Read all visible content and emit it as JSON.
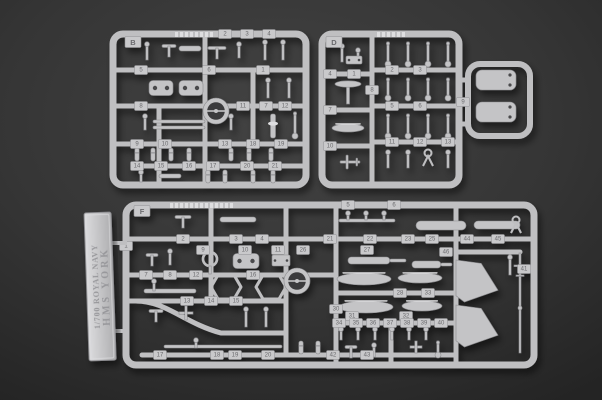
{
  "photo": {
    "type": "product-photo",
    "subject": "injection-molded plastic model kit sprues on dark backdrop",
    "width": 602,
    "height": 400
  },
  "colors": {
    "bg_center": "#434343",
    "bg_mid": "#353535",
    "bg_edge": "#242424",
    "plastic": "#c4c4c6",
    "plastic_light": "#dedee0",
    "plastic_dark": "#8b8b8e",
    "rail": "#bfbfc1",
    "tag_fill": "#c9c9cb",
    "tag_edge": "#8e8e91",
    "tag_text": "#6b6b6e",
    "hole": "#4a4a4c",
    "ring_hole": "#3a3a3c",
    "shell_band": "#a0a0a3",
    "plate_light": "#dcdcde",
    "plate_dark": "#aeaeb0",
    "plate_text": "#96969a",
    "plate_edge": "#8f8f93"
  },
  "nameplate": {
    "line1": "1/700 ROYAL NAVY",
    "line2": "HMS YORK",
    "x": 84,
    "y": 213,
    "w": 27,
    "h": 148,
    "tilt": -2,
    "connectors": [
      [
        109,
        241,
        18,
        4
      ],
      [
        107,
        329,
        20,
        4
      ]
    ]
  },
  "sprues": [
    {
      "id": "sprue-b",
      "label": "B",
      "label_pos": [
        20,
        8
      ],
      "frame": {
        "x": 113,
        "y": 34,
        "w": 193,
        "h": 151,
        "r": 10
      },
      "rails": [
        [
          0,
          36,
          193,
          36
        ],
        [
          0,
          72,
          193,
          72
        ],
        [
          0,
          110,
          193,
          110
        ],
        [
          24,
          132,
          193,
          132
        ],
        [
          92,
          0,
          92,
          151
        ],
        [
          46,
          72,
          46,
          151
        ],
        [
          140,
          36,
          140,
          110
        ]
      ],
      "curves": [],
      "loops": [],
      "tags": [
        [
          "2",
          112,
          0
        ],
        [
          "3",
          134,
          0
        ],
        [
          "4",
          156,
          0
        ],
        [
          "5",
          28,
          36
        ],
        [
          "6",
          96,
          36
        ],
        [
          "1",
          150,
          36
        ],
        [
          "8",
          28,
          72
        ],
        [
          "11",
          130,
          72
        ],
        [
          "7",
          153,
          72
        ],
        [
          "12",
          172,
          72
        ],
        [
          "9",
          24,
          110
        ],
        [
          "10",
          52,
          110
        ],
        [
          "13",
          112,
          110
        ],
        [
          "18",
          140,
          110
        ],
        [
          "19",
          168,
          110
        ],
        [
          "14",
          24,
          132
        ],
        [
          "15",
          48,
          132
        ],
        [
          "16",
          76,
          132
        ],
        [
          "17",
          100,
          132
        ],
        [
          "20",
          134,
          132
        ],
        [
          "21",
          162,
          132
        ]
      ],
      "parts": [
        [
          "ridge",
          62,
          -2,
          36
        ],
        [
          "pinu",
          34,
          8,
          18
        ],
        [
          "tee",
          56,
          12,
          14
        ],
        [
          "barh",
          66,
          12,
          22,
          5
        ],
        [
          "tee",
          104,
          14,
          18
        ],
        [
          "pinu",
          126,
          8,
          16
        ],
        [
          "pinu",
          152,
          6,
          20
        ],
        [
          "pinu",
          170,
          6,
          20
        ],
        [
          "clamp",
          48,
          54,
          24,
          15
        ],
        [
          "clamp",
          78,
          54,
          24,
          15
        ],
        [
          "ringbig",
          103,
          77,
          13
        ],
        [
          "pinu",
          155,
          44,
          20
        ],
        [
          "pinu",
          176,
          44,
          20
        ],
        [
          "colm",
          160,
          80,
          24
        ],
        [
          "pinb",
          182,
          78,
          26
        ],
        [
          "pinu",
          32,
          80,
          16
        ],
        [
          "barh",
          40,
          86,
          52,
          3
        ],
        [
          "barh",
          40,
          92,
          52,
          3
        ],
        [
          "pinu",
          118,
          80,
          16
        ],
        [
          "shell",
          24,
          114
        ],
        [
          "shell",
          40,
          114
        ],
        [
          "shell",
          58,
          114
        ],
        [
          "shell",
          76,
          114
        ],
        [
          "shell",
          118,
          114
        ],
        [
          "shell",
          136,
          114
        ],
        [
          "shell",
          158,
          114
        ],
        [
          "pinu",
          28,
          136,
          12
        ],
        [
          "barh",
          46,
          140,
          22,
          4
        ],
        [
          "shell",
          95,
          136
        ],
        [
          "shell",
          112,
          136
        ],
        [
          "shell",
          140,
          136
        ],
        [
          "shell",
          160,
          136
        ]
      ]
    },
    {
      "id": "sprue-d",
      "label": "D",
      "label_pos": [
        12,
        8
      ],
      "frame": {
        "x": 322,
        "y": 34,
        "w": 137,
        "h": 151,
        "r": 10
      },
      "rails": [
        [
          0,
          40,
          50,
          40
        ],
        [
          0,
          76,
          50,
          76
        ],
        [
          0,
          112,
          50,
          112
        ],
        [
          50,
          36,
          137,
          36
        ],
        [
          50,
          72,
          137,
          72
        ],
        [
          50,
          108,
          137,
          108
        ],
        [
          50,
          0,
          50,
          151
        ],
        [
          137,
          46,
          146,
          46
        ],
        [
          137,
          90,
          146,
          90
        ]
      ],
      "curves": [],
      "loops": [
        [
          146,
          30,
          62,
          72,
          12
        ]
      ],
      "tags": [
        [
          "1",
          32,
          40
        ],
        [
          "4",
          8,
          40
        ],
        [
          "7",
          8,
          76
        ],
        [
          "10",
          8,
          112
        ],
        [
          "2",
          70,
          36
        ],
        [
          "3",
          98,
          36
        ],
        [
          "5",
          70,
          72
        ],
        [
          "6",
          98,
          72
        ],
        [
          "8",
          50,
          56
        ],
        [
          "11",
          70,
          108
        ],
        [
          "12",
          98,
          108
        ],
        [
          "13",
          126,
          108
        ],
        [
          "9",
          141,
          68
        ]
      ],
      "parts": [
        [
          "ridge",
          55,
          -2,
          30
        ],
        [
          "pinu",
          20,
          10,
          18
        ],
        [
          "pinu",
          36,
          14,
          14
        ],
        [
          "plate",
          24,
          22,
          16,
          8
        ],
        [
          "mush",
          26,
          56,
          13
        ],
        [
          "boat",
          26,
          94,
          16,
          4
        ],
        [
          "plane",
          28,
          128
        ],
        [
          "pinb",
          66,
          8,
          24
        ],
        [
          "pinb",
          86,
          8,
          24
        ],
        [
          "pinb",
          106,
          8,
          24
        ],
        [
          "pinb",
          126,
          8,
          24
        ],
        [
          "pinb",
          66,
          44,
          22
        ],
        [
          "pinb",
          86,
          44,
          22
        ],
        [
          "pinb",
          106,
          44,
          22
        ],
        [
          "pinb",
          126,
          44,
          22
        ],
        [
          "pinb",
          66,
          80,
          24
        ],
        [
          "pinb",
          86,
          80,
          24
        ],
        [
          "pinb",
          106,
          80,
          24
        ],
        [
          "pinb",
          126,
          80,
          24
        ],
        [
          "pinu",
          66,
          116,
          18
        ],
        [
          "pinu",
          86,
          116,
          18
        ],
        [
          "yfork",
          106,
          124
        ],
        [
          "pinu",
          126,
          116,
          18
        ],
        [
          "pod",
          154,
          36,
          40,
          20
        ],
        [
          "pod",
          154,
          68,
          40,
          20
        ]
      ]
    },
    {
      "id": "sprue-f",
      "label": "F",
      "label_pos": [
        16,
        6
      ],
      "frame": {
        "x": 126,
        "y": 205,
        "w": 408,
        "h": 160,
        "r": 10
      },
      "rails": [
        [
          0,
          34,
          408,
          34
        ],
        [
          0,
          70,
          210,
          70
        ],
        [
          0,
          96,
          160,
          96
        ],
        [
          210,
          88,
          330,
          88
        ],
        [
          210,
          118,
          330,
          118
        ],
        [
          16,
          150,
          330,
          150
        ],
        [
          330,
          47,
          394,
          47
        ],
        [
          85,
          0,
          85,
          96
        ],
        [
          160,
          0,
          160,
          150
        ],
        [
          210,
          0,
          210,
          160
        ],
        [
          330,
          0,
          330,
          160
        ],
        [
          265,
          118,
          265,
          160
        ]
      ],
      "curves": [
        "M10,96 C40,96 58,118 95,128 L160,128"
      ],
      "loops": [],
      "tags": [
        [
          "1",
          0,
          41
        ],
        [
          "2",
          57,
          34
        ],
        [
          "3",
          110,
          34
        ],
        [
          "4",
          136,
          34
        ],
        [
          "21",
          204,
          34
        ],
        [
          "22",
          244,
          34
        ],
        [
          "23",
          282,
          34
        ],
        [
          "25",
          306,
          34
        ],
        [
          "44",
          341,
          34
        ],
        [
          "45",
          372,
          34
        ],
        [
          "5",
          222,
          0
        ],
        [
          "6",
          268,
          0
        ],
        [
          "9",
          77,
          45
        ],
        [
          "10",
          119,
          45
        ],
        [
          "11",
          152,
          45
        ],
        [
          "26",
          177,
          45
        ],
        [
          "27",
          241,
          45
        ],
        [
          "7",
          20,
          70
        ],
        [
          "8",
          44,
          70
        ],
        [
          "12",
          70,
          70
        ],
        [
          "16",
          127,
          70
        ],
        [
          "13",
          61,
          96
        ],
        [
          "14",
          85,
          96
        ],
        [
          "15",
          110,
          96
        ],
        [
          "28",
          274,
          88
        ],
        [
          "33",
          302,
          88
        ],
        [
          "30",
          210,
          104
        ],
        [
          "31",
          226,
          111
        ],
        [
          "32",
          280,
          111
        ],
        [
          "34",
          213,
          118
        ],
        [
          "35",
          230,
          118
        ],
        [
          "36",
          247,
          118
        ],
        [
          "37",
          264,
          118
        ],
        [
          "38",
          281,
          118
        ],
        [
          "39",
          298,
          118
        ],
        [
          "40",
          315,
          118
        ],
        [
          "17",
          34,
          150
        ],
        [
          "18",
          91,
          150
        ],
        [
          "19",
          109,
          150
        ],
        [
          "20",
          142,
          150
        ],
        [
          "42",
          207,
          150
        ],
        [
          "43",
          241,
          150
        ],
        [
          "46",
          320,
          47
        ],
        [
          "41",
          398,
          64
        ]
      ],
      "parts": [
        [
          "ridge",
          44,
          -2,
          64
        ],
        [
          "tee",
          57,
          12,
          16
        ],
        [
          "barh",
          94,
          12,
          36,
          5
        ],
        [
          "barh",
          213,
          14,
          56,
          3
        ],
        [
          "pinu",
          222,
          6,
          9
        ],
        [
          "pinu",
          240,
          6,
          9
        ],
        [
          "pinu",
          258,
          6,
          9
        ],
        [
          "barh",
          290,
          16,
          50,
          9
        ],
        [
          "barh",
          348,
          16,
          46,
          8
        ],
        [
          "yfork",
          390,
          20
        ],
        [
          "tee",
          26,
          50,
          12
        ],
        [
          "pinu",
          44,
          44,
          16
        ],
        [
          "ringsm",
          84,
          54,
          7
        ],
        [
          "clamp",
          120,
          56,
          26,
          15
        ],
        [
          "plate",
          146,
          50,
          18,
          11
        ],
        [
          "gun",
          222,
          52,
          58
        ],
        [
          "gun",
          286,
          56,
          40
        ],
        [
          "tri",
          330,
          55,
          42,
          42
        ],
        [
          "tri",
          330,
          100,
          42,
          42
        ],
        [
          "mastv",
          394,
          48,
          100
        ],
        [
          "pinu",
          384,
          50,
          20
        ],
        [
          "barh",
          18,
          84,
          52,
          4
        ],
        [
          "pinu",
          28,
          74,
          12
        ],
        [
          "hex",
          100,
          82
        ],
        [
          "hex",
          145,
          82
        ],
        [
          "ringbig",
          171,
          76,
          13
        ],
        [
          "boat",
          238,
          74,
          27,
          6
        ],
        [
          "boat",
          294,
          73,
          22,
          5
        ],
        [
          "boat",
          240,
          102,
          27,
          6
        ],
        [
          "boat",
          296,
          101,
          20,
          5
        ],
        [
          "tee",
          30,
          106,
          14
        ],
        [
          "cross",
          60,
          108,
          14
        ],
        [
          "pinu",
          120,
          102,
          20
        ],
        [
          "pinu",
          140,
          102,
          20
        ],
        [
          "barh",
          38,
          140,
          118,
          3
        ],
        [
          "pinu",
          70,
          133,
          10
        ],
        [
          "pinu",
          215,
          122,
          13
        ],
        [
          "pinu",
          232,
          122,
          13
        ],
        [
          "pinu",
          249,
          122,
          13
        ],
        [
          "pinu",
          266,
          122,
          13
        ],
        [
          "pinu",
          283,
          122,
          13
        ],
        [
          "pinu",
          300,
          122,
          13
        ],
        [
          "shell",
          175,
          136
        ],
        [
          "shell",
          192,
          136
        ],
        [
          "tee",
          225,
          142,
          12
        ],
        [
          "pinu",
          248,
          138,
          14
        ],
        [
          "cross",
          290,
          142,
          12
        ],
        [
          "pinb",
          312,
          136,
          16
        ]
      ]
    }
  ]
}
